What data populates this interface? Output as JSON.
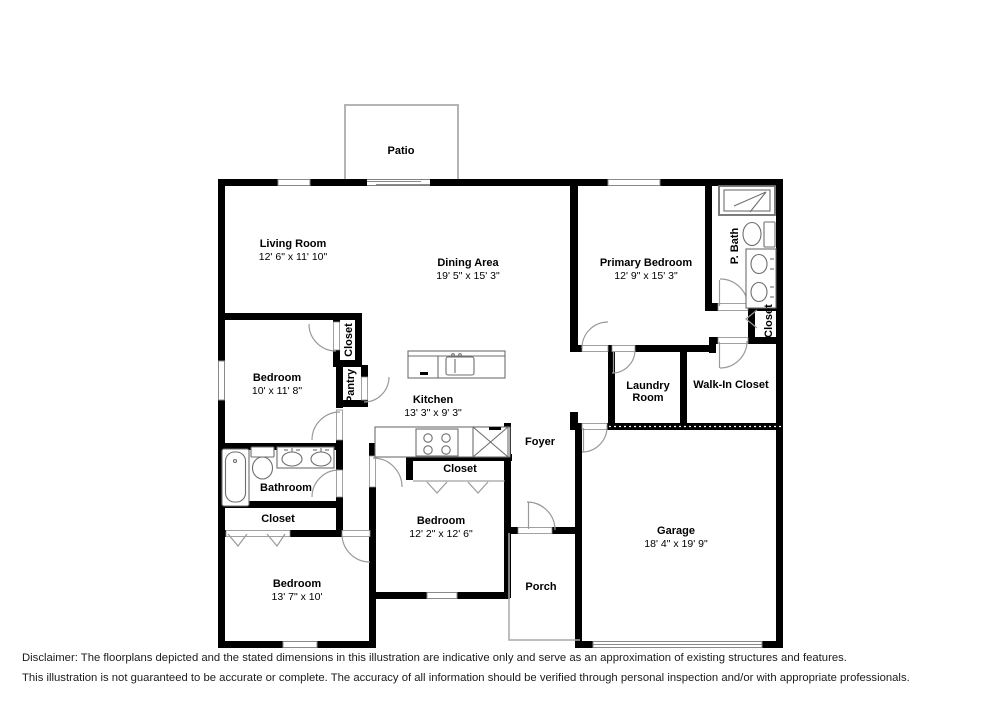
{
  "colors": {
    "wall": "#000000",
    "fixture": "#6e6e6e",
    "door_arc": "#9a9a9a",
    "window_line": "#8a8a8a",
    "patio_outline": "#b4b4b4",
    "text": "#000000"
  },
  "rooms": {
    "patio": {
      "name": "Patio"
    },
    "living_room": {
      "name": "Living Room",
      "dims": "12' 6\" x 11' 10\""
    },
    "dining_area": {
      "name": "Dining Area",
      "dims": "19' 5\" x 15' 3\""
    },
    "primary_bedroom": {
      "name": "Primary Bedroom",
      "dims": "12' 9\" x 15' 3\""
    },
    "p_bath": {
      "name": "P. Bath"
    },
    "primary_closet": {
      "name": "Closet"
    },
    "bedroom_2": {
      "name": "Bedroom",
      "dims": "10' x 11' 8\""
    },
    "closet_2": {
      "name": "Closet"
    },
    "pantry": {
      "name": "Pantry"
    },
    "kitchen": {
      "name": "Kitchen",
      "dims": "13' 3\" x 9' 3\""
    },
    "laundry": {
      "line1": "Laundry",
      "line2": "Room"
    },
    "walk_in_closet": {
      "name": "Walk-In Closet"
    },
    "foyer": {
      "name": "Foyer"
    },
    "bathroom": {
      "name": "Bathroom"
    },
    "hall_closet": {
      "name": "Closet"
    },
    "bedroom_3_closet": {
      "name": "Closet"
    },
    "bedroom_3": {
      "name": "Bedroom",
      "dims": "12' 2\" x 12' 6\""
    },
    "bedroom_4": {
      "name": "Bedroom",
      "dims": "13' 7\" x 10'"
    },
    "porch": {
      "name": "Porch"
    },
    "garage": {
      "name": "Garage",
      "dims": "18' 4\" x 19' 9\""
    }
  },
  "disclaimer": {
    "line1": "Disclaimer: The floorplans depicted and the stated dimensions in this illustration are indicative only and serve as an approximation of existing structures and features.",
    "line2": "This illustration is not guaranteed to be accurate or complete. The accuracy of all information should be verified through personal inspection and/or with appropriate professionals."
  }
}
